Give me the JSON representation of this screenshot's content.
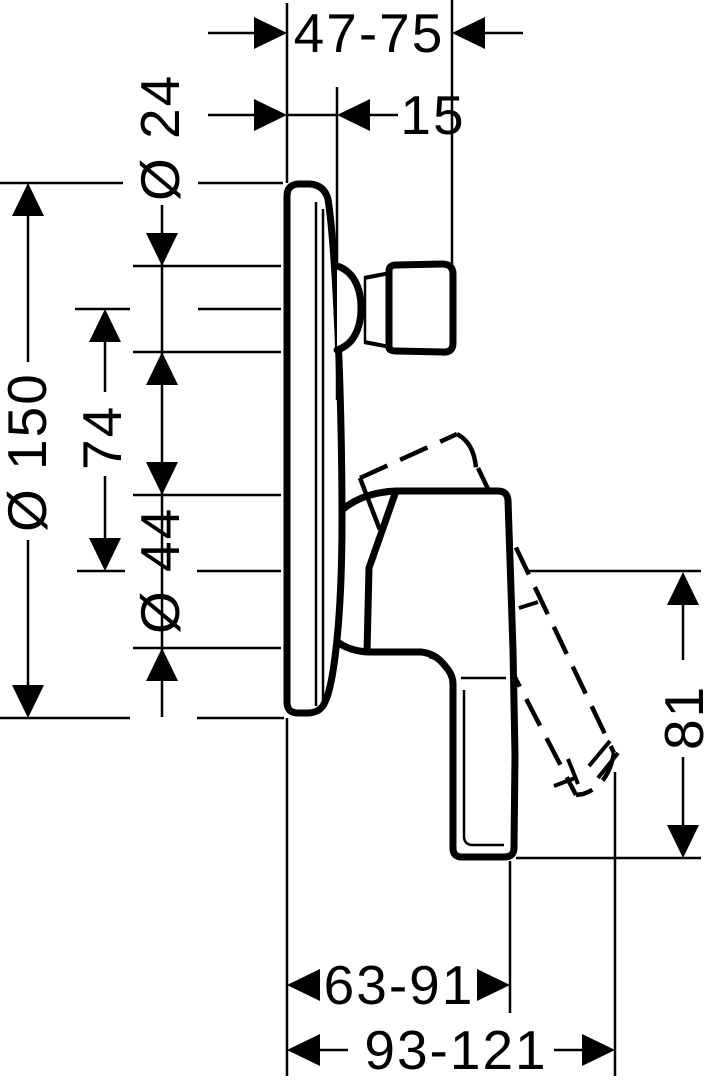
{
  "drawing": {
    "kind": "technical-dimension-drawing",
    "background": "#ffffff",
    "line_color": "#000000"
  },
  "dimensions": {
    "rough_in_depth": {
      "label": "47-75"
    },
    "plate_projection": {
      "label": "15"
    },
    "connector_diameter": {
      "label": "Ø 24"
    },
    "plate_diameter": {
      "label": "Ø 150"
    },
    "axis_spacing": {
      "label": "74"
    },
    "body_diameter": {
      "label": "Ø 44"
    },
    "lever_height": {
      "label": "81"
    },
    "grip_depth_range": {
      "label": "63-91"
    },
    "lever_depth_range": {
      "label": "93-121"
    }
  }
}
